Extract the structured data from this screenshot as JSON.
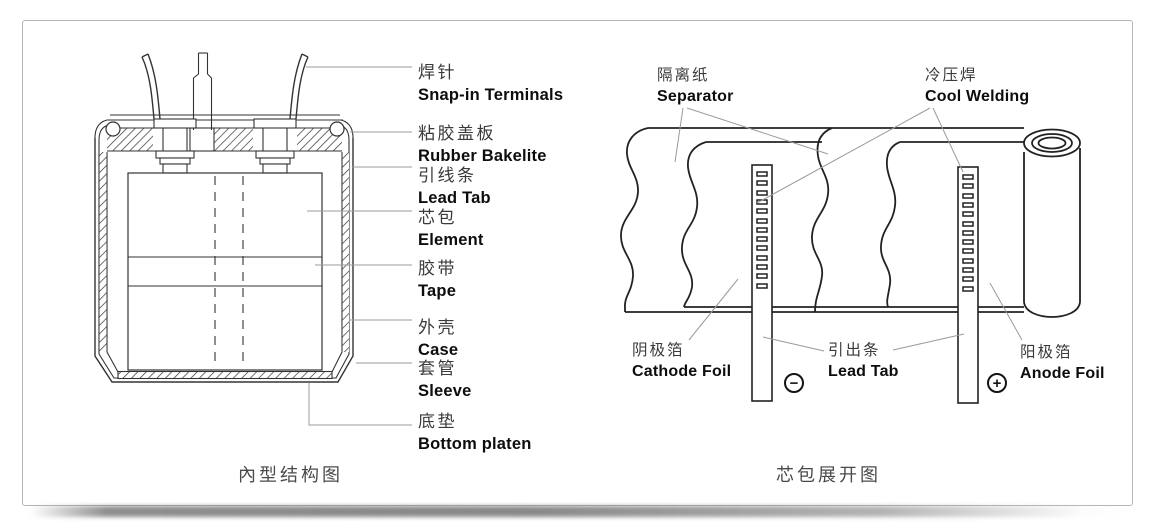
{
  "page": {
    "background": "#ffffff",
    "panel_border_color": "#b5b5b5"
  },
  "left_diagram": {
    "caption": "內型结构图",
    "labels": [
      {
        "id": "snap-in-terminals",
        "zh": "焊针",
        "en": "Snap-in Terminals"
      },
      {
        "id": "rubber-bakelite",
        "zh": "粘胶盖板",
        "en": "Rubber Bakelite"
      },
      {
        "id": "lead-tab",
        "zh": "引线条",
        "en": "Lead Tab"
      },
      {
        "id": "element",
        "zh": "芯包",
        "en": "Element"
      },
      {
        "id": "tape",
        "zh": "胶带",
        "en": "Tape"
      },
      {
        "id": "case",
        "zh": "外壳",
        "en": "Case"
      },
      {
        "id": "sleeve",
        "zh": "套管",
        "en": "Sleeve"
      },
      {
        "id": "bottom-platen",
        "zh": "底垫",
        "en": "Bottom platen"
      }
    ]
  },
  "right_diagram": {
    "caption": "芯包展开图",
    "labels": [
      {
        "id": "separator",
        "zh": "隔离纸",
        "en": "Separator"
      },
      {
        "id": "cool-welding",
        "zh": "冷压焊",
        "en": "Cool Welding"
      },
      {
        "id": "cathode-foil",
        "zh": "阴极箔",
        "en": "Cathode Foil"
      },
      {
        "id": "lead-tab-out",
        "zh": "引出条",
        "en": "Lead Tab"
      },
      {
        "id": "anode-foil",
        "zh": "阳极箔",
        "en": "Anode Foil"
      }
    ],
    "polarity_negative": "−",
    "polarity_positive": "+"
  }
}
